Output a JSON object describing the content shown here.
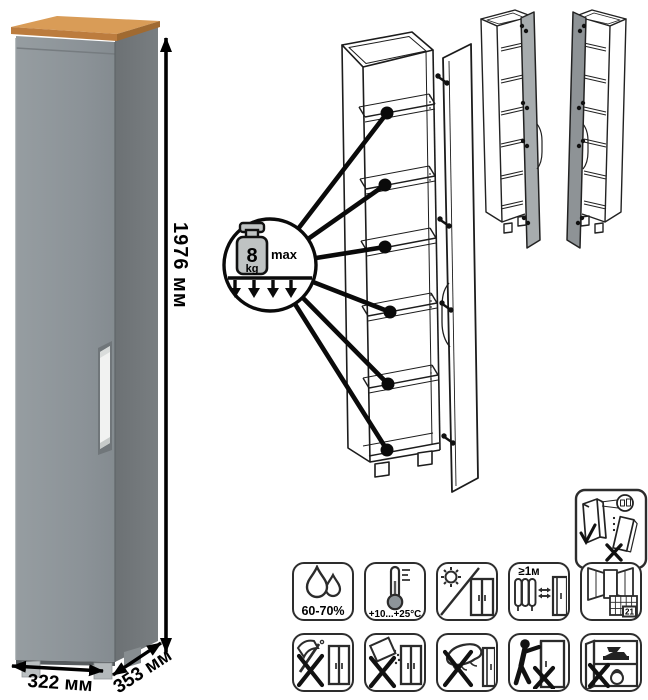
{
  "page": {
    "background": "#ffffff"
  },
  "photo": {
    "height_label": "1976 мм",
    "width_label": "322 мм",
    "depth_label": "353 мм",
    "colors": {
      "front_door": "#8d9499",
      "side_panel": "#74797c",
      "top_wood": "#c8853f",
      "handle": "#f1f2f1"
    }
  },
  "callout": {
    "weight_value": "8",
    "weight_unit": "kg",
    "max_label": "max"
  },
  "care_icons": [
    {
      "name": "humidity-icon",
      "label": "60-70%"
    },
    {
      "name": "temperature-range-icon",
      "label": "+10...+25°C"
    },
    {
      "name": "no-direct-sunlight-icon",
      "label": ""
    },
    {
      "name": "heat-source-distance-icon",
      "label": "≥1м"
    },
    {
      "name": "ventilation-acclimatization-icon",
      "label": "21"
    },
    {
      "name": "no-impact-icon",
      "label": ""
    },
    {
      "name": "no-abrasives-icon",
      "label": ""
    },
    {
      "name": "no-wet-cleaning-icon",
      "label": ""
    },
    {
      "name": "no-dragging-icon",
      "label": ""
    },
    {
      "name": "no-overload-icon",
      "label": ""
    }
  ],
  "wall_icon": {
    "name": "anti-tip-wall-mount-icon"
  }
}
